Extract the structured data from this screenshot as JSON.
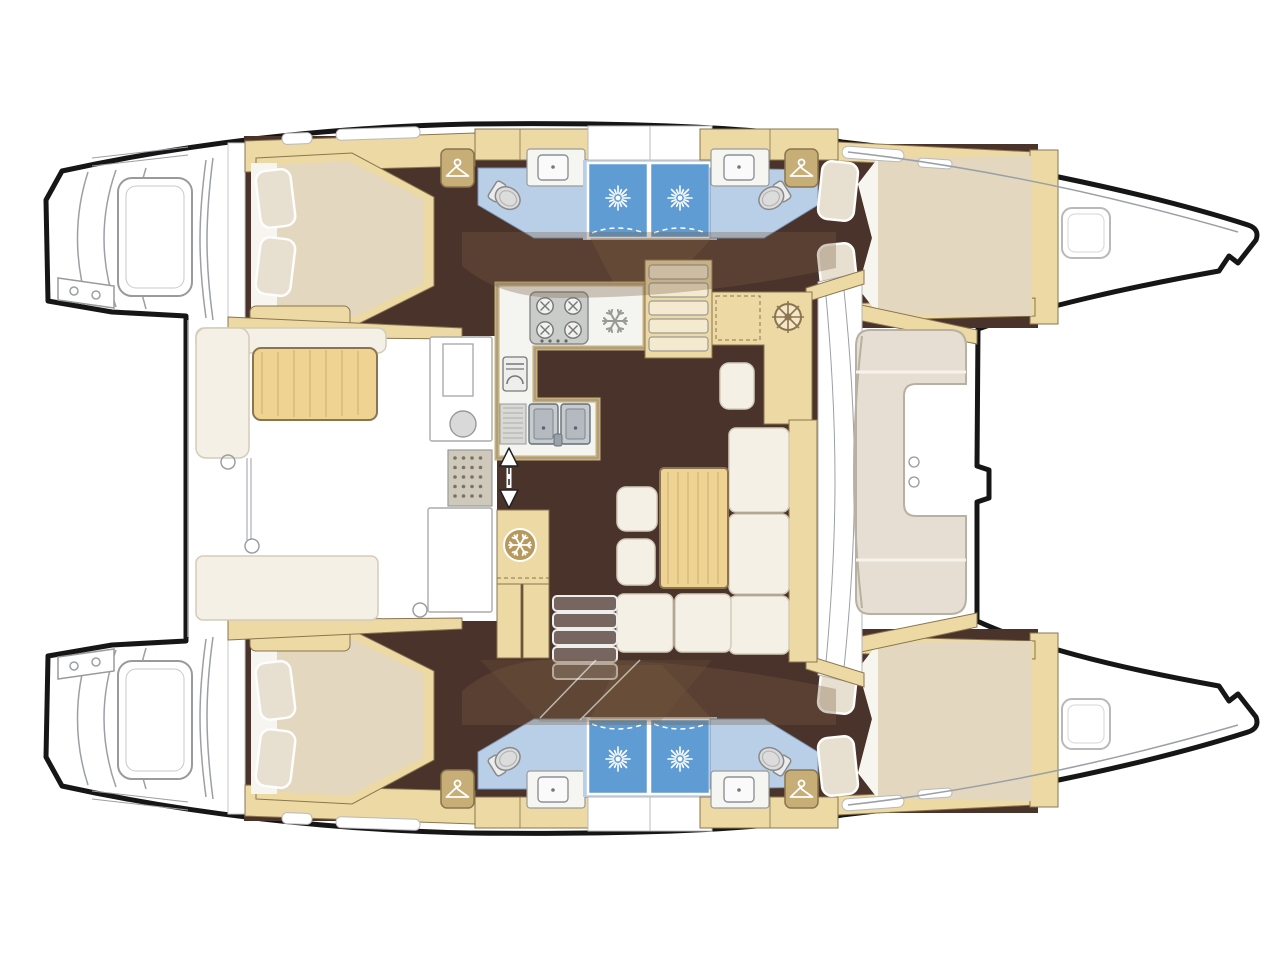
{
  "meta": {
    "diagram_type": "boat deck floor plan",
    "vessel_type": "sailing catamaran",
    "view": "top-down interior layout, bows pointing right",
    "cabins": 4,
    "bathrooms": 4,
    "shower_stalls": 4
  },
  "colors": {
    "outline": "#161616",
    "line": "#9aa0a6",
    "white": "#ffffff",
    "floor": "#4a332b",
    "wood": "#ecd9a4",
    "tableWood": "#eed393",
    "woodEdge": "#8a7550",
    "closet": "#c7ad76",
    "cushion": "#f4f0e5",
    "cushionEdge": "#d4ccba",
    "mattress": "#e3d7c0",
    "bath": "#b9cfe7",
    "shower": "#5f9cd3",
    "steel": "#c6cbd0",
    "fixture": "#dcdcdc",
    "overlay": "rgba(122,94,66,0.32)"
  },
  "rooms": {
    "port_hull": {
      "aft_cabin": "double berth cabin",
      "aft_head": "toilet + washbasin + shower stall",
      "forward_head": "toilet + washbasin + shower stall",
      "forward_cabin": "double berth cabin",
      "stern": "transom steps / swim platform"
    },
    "starboard_hull": {
      "aft_cabin": "double berth cabin",
      "aft_head": "toilet + washbasin + shower stall",
      "forward_head": "toilet + washbasin + shower stall",
      "forward_cabin": "double berth cabin",
      "stern": "transom steps / swim platform"
    },
    "saloon": {
      "galley": "U-shaped galley with stove, oven, double sink, fridge",
      "nav_station": "chart table with helm-wheel panel",
      "dinette": "L-shaped sofa with table and two stools",
      "companionways": "stairs down to each hull"
    },
    "aft_cockpit": "L-bench, table and aft bench",
    "forward_cockpit": "C-shaped lounge seat with table"
  },
  "icons": {
    "coat_hanger": "hanger-icon (wardrobe locker), 4 instances",
    "shower_spray": "sunburst-spray-icon on shower stalls, 4 instances",
    "snowflake_galley": "snowflake-icon on galley counter (freezer)",
    "snowflake_fridge": "snowflake-icon on saloon cabinet (fridge)",
    "stove": "4-burner-stove-icon",
    "oven": "oven-icon",
    "double_sink": "double-sink-icon",
    "toilet": "toilet-icon, 4 instances",
    "sliding_door_arrow": "double-headed-arrow-icon at saloon sliding door"
  }
}
